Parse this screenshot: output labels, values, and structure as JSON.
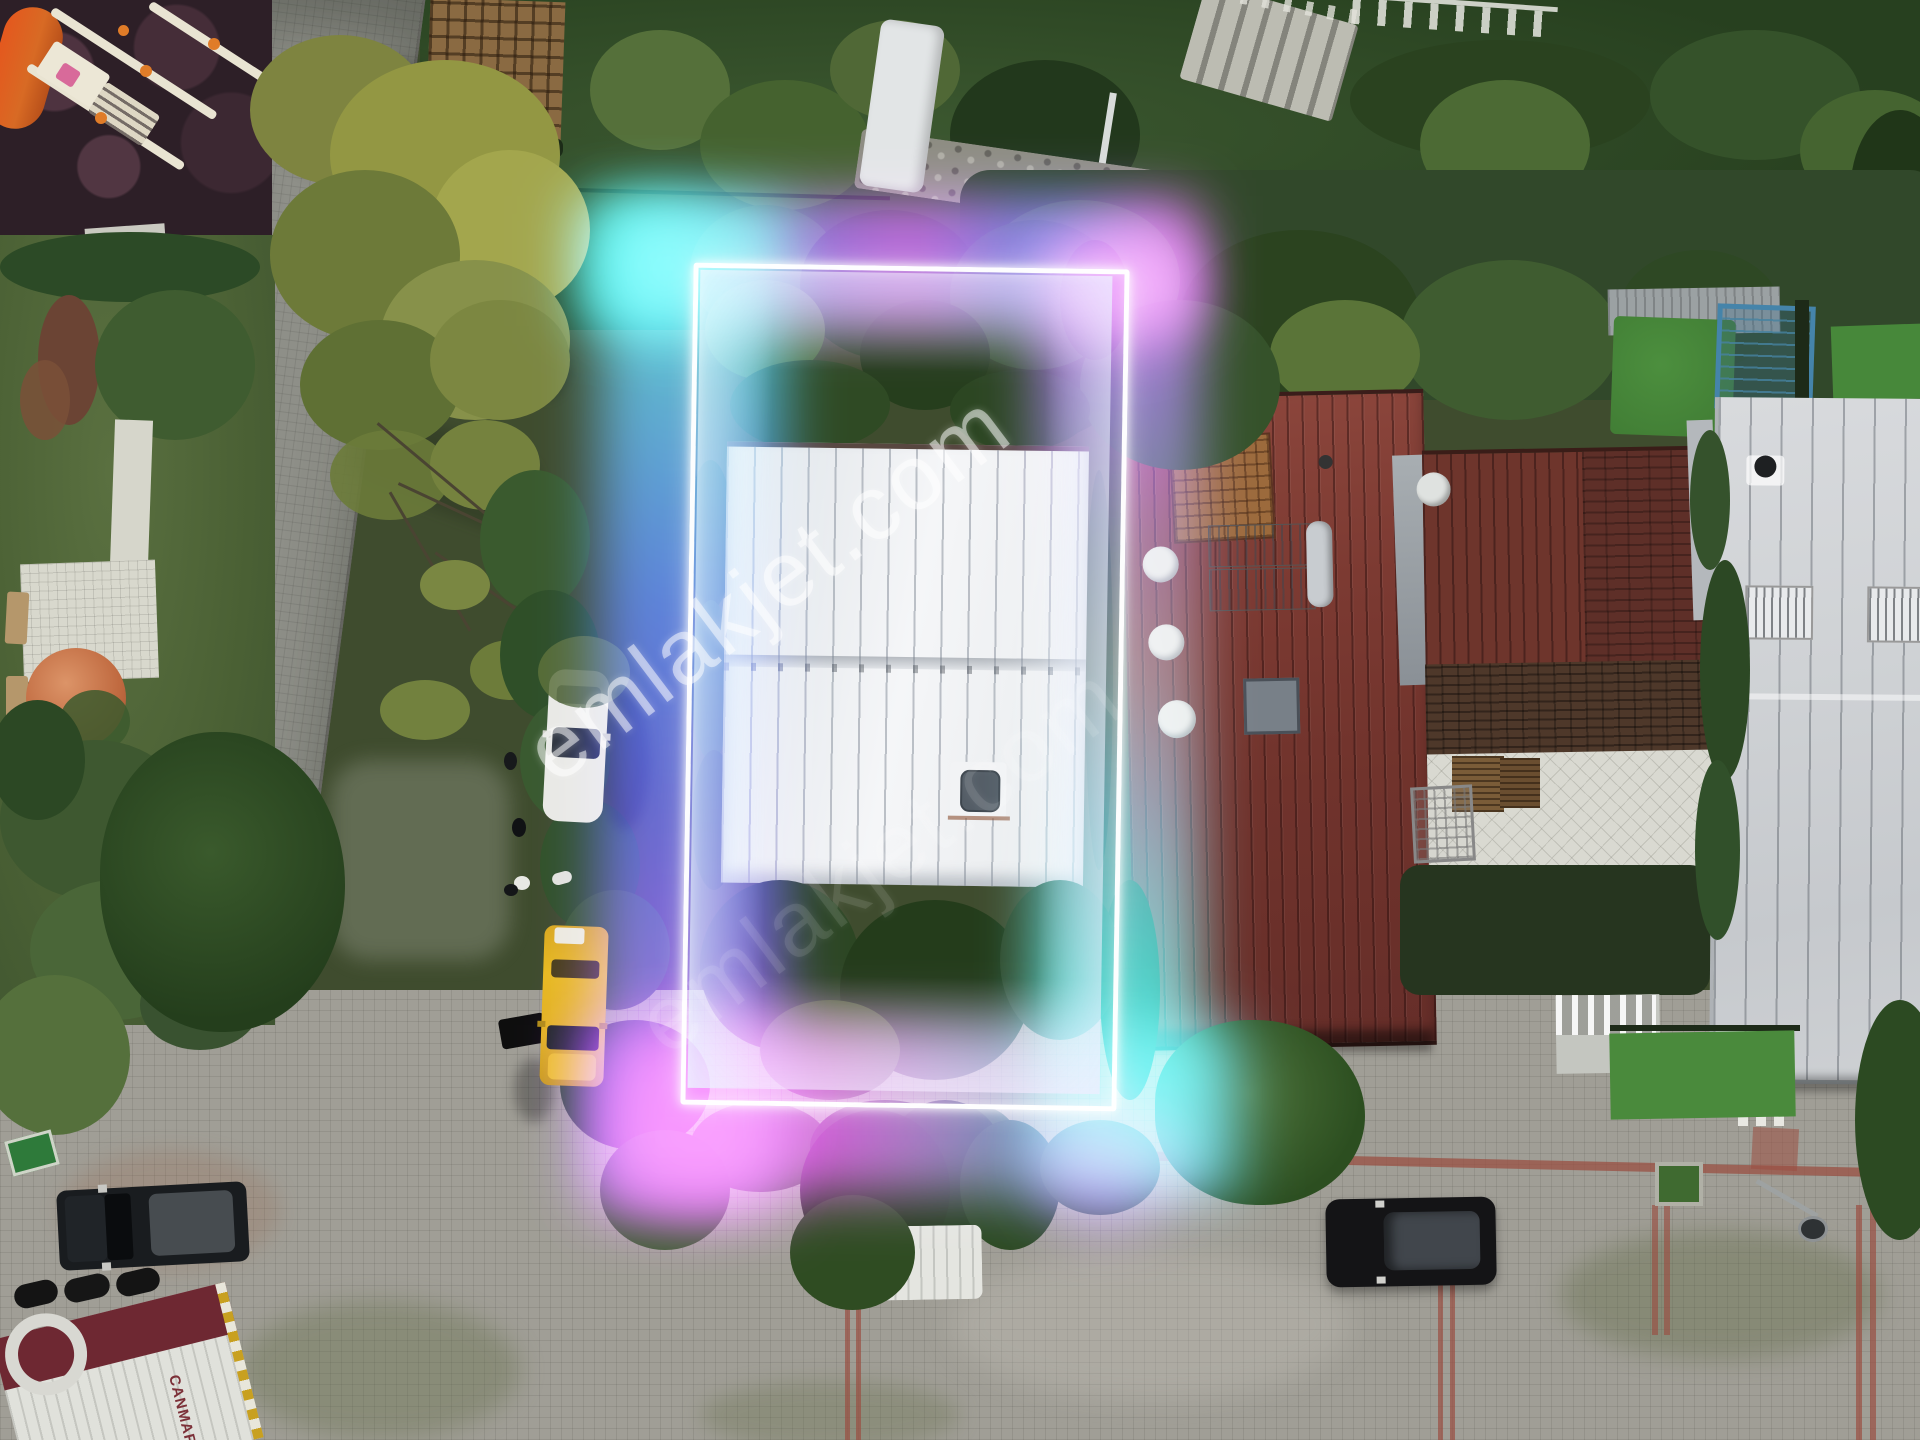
{
  "scene": {
    "description": "Aerial drone photo of a residential block with a glowing neon rectangle outlining a property with a white metal roof",
    "watermark": {
      "text": "emlakjet.com"
    },
    "truck": {
      "brand_text": "CANMAR"
    },
    "highlight": {
      "border_color": "#ffffff",
      "glow_cyan": "#2ee2da",
      "glow_blue": "#2d55e8",
      "glow_violet": "#8a2be2",
      "glow_magenta": "#d42ad8"
    },
    "palette": {
      "taxi_yellow": "#e8b91f",
      "white_roof": "#eef0f3",
      "maroon_roof": "#7c3a32",
      "street_gray": "#8e8f88",
      "tree_green": "#33522a"
    }
  }
}
